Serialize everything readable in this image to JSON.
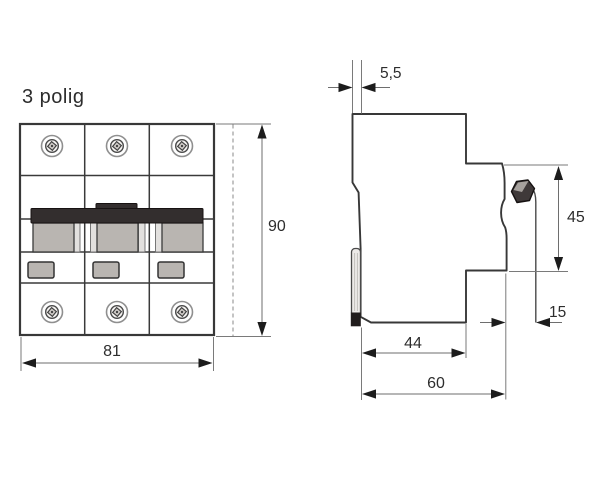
{
  "labels": {
    "pole_count": "3 polig"
  },
  "dimensions": {
    "front_width": "81",
    "front_height": "90",
    "rail_clip_depth": "5,5",
    "handle_height": "45",
    "front_depth": "15",
    "base_depth": "44",
    "total_depth": "60"
  },
  "colors": {
    "line": "#383838",
    "dim_arrow": "#1c1c1c",
    "handle": "#332e2e",
    "component": "#b9b5b1",
    "window": "#b9b5b1",
    "clip": "#eceae8",
    "knob": "#3f3939",
    "knob_top": "#a6a19d",
    "foot": "#201c1c"
  }
}
